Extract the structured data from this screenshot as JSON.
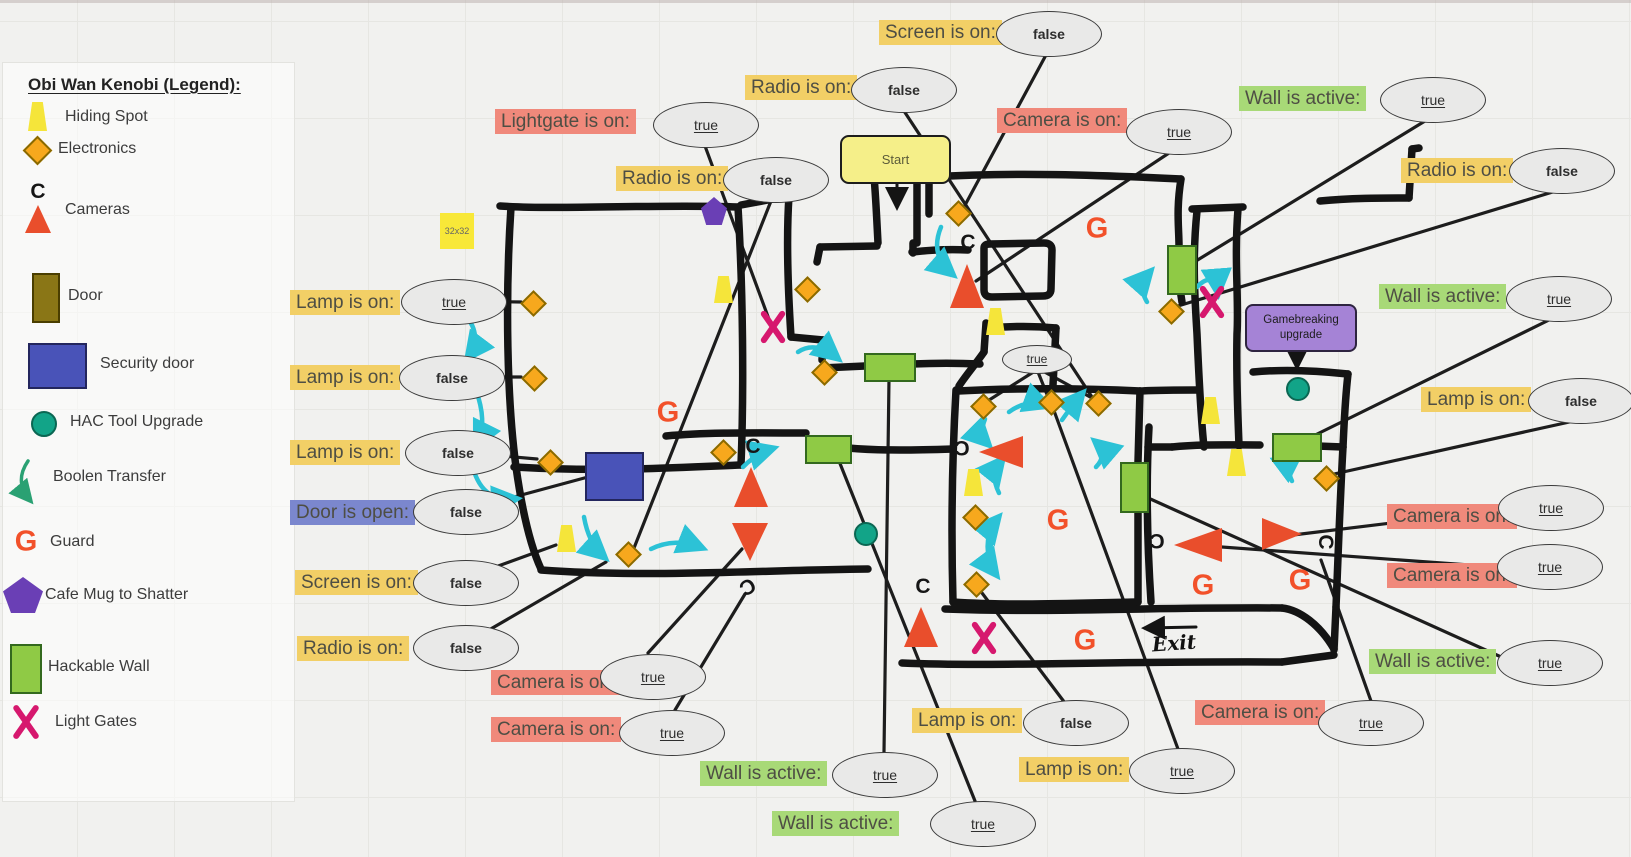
{
  "legend": {
    "title": "Obi Wan Kenobi (Legend):",
    "items": [
      {
        "icon": "hiding-spot",
        "label": "Hiding Spot",
        "y": 117,
        "icon_x": 38,
        "label_x": 65
      },
      {
        "icon": "electronics",
        "label": "Electronics",
        "y": 149,
        "icon_x": 36,
        "label_x": 58
      },
      {
        "icon": "camera",
        "label": "Cameras",
        "y": 210,
        "icon_x": 38,
        "label_x": 65
      },
      {
        "icon": "door",
        "label": "Door",
        "y": 296,
        "icon_x": 44,
        "label_x": 68
      },
      {
        "icon": "security-door",
        "label": "Security door",
        "y": 364,
        "icon_x": 55,
        "label_x": 100
      },
      {
        "icon": "hac-tool",
        "label": "HAC Tool Upgrade",
        "y": 422,
        "icon_x": 42,
        "label_x": 70
      },
      {
        "icon": "boolean-transfer",
        "label": "Boolen Transfer",
        "y": 477,
        "icon_x": 26,
        "label_x": 53
      },
      {
        "icon": "guard",
        "label": "Guard",
        "y": 542,
        "icon_x": 26,
        "label_x": 50
      },
      {
        "icon": "cafe-mug",
        "label": "Cafe Mug to Shatter",
        "y": 595,
        "icon_x": 23,
        "label_x": 45
      },
      {
        "icon": "hackable-wall",
        "label": "Hackable Wall",
        "y": 667,
        "icon_x": 24,
        "label_x": 48
      },
      {
        "icon": "light-gate",
        "label": "Light Gates",
        "y": 722,
        "icon_x": 26,
        "label_x": 55
      }
    ]
  },
  "notes": {
    "start": "Start",
    "exit": "Exit",
    "size_note": "32x32",
    "upgrade_line1": "Gamebreaking",
    "upgrade_line2": "upgrade"
  },
  "marks": {
    "guard_letter": "G",
    "camera_letter": "C"
  },
  "annotations": [
    {
      "id": "screen-top",
      "label": "Screen is on:",
      "bg": "yellow",
      "lx": 879,
      "ly": 20,
      "ex": 1048,
      "ey": 33,
      "value": "false"
    },
    {
      "id": "radio-top",
      "label": "Radio is on:",
      "bg": "yellow",
      "lx": 745,
      "ly": 75,
      "ex": 903,
      "ey": 89,
      "value": "false"
    },
    {
      "id": "lightgate-top",
      "label": "Lightgate is on:",
      "bg": "salmon",
      "lx": 495,
      "ly": 109,
      "ex": 705,
      "ey": 124,
      "value": "true"
    },
    {
      "id": "radio-mid",
      "label": "Radio is on:",
      "bg": "yellow",
      "lx": 616,
      "ly": 166,
      "ex": 775,
      "ey": 179,
      "value": "false"
    },
    {
      "id": "camera-top",
      "label": "Camera is on:",
      "bg": "salmon",
      "lx": 997,
      "ly": 108,
      "ex": 1178,
      "ey": 131,
      "value": "true"
    },
    {
      "id": "wall-top",
      "label": "Wall is active:",
      "bg": "green",
      "lx": 1239,
      "ly": 86,
      "ex": 1432,
      "ey": 99,
      "value": "true"
    },
    {
      "id": "radio-right",
      "label": "Radio is on:",
      "bg": "yellow",
      "lx": 1401,
      "ly": 158,
      "ex": 1561,
      "ey": 170,
      "value": "false"
    },
    {
      "id": "wall-right",
      "label": "Wall is active:",
      "bg": "green",
      "lx": 1379,
      "ly": 284,
      "ex": 1558,
      "ey": 298,
      "value": "true"
    },
    {
      "id": "lamp-right",
      "label": "Lamp is on:",
      "bg": "yellow",
      "lx": 1421,
      "ly": 387,
      "ex": 1580,
      "ey": 400,
      "value": "false"
    },
    {
      "id": "lamp-1",
      "label": "Lamp is on:",
      "bg": "yellow",
      "lx": 290,
      "ly": 290,
      "ex": 453,
      "ey": 301,
      "value": "true"
    },
    {
      "id": "lamp-2",
      "label": "Lamp is on:",
      "bg": "yellow",
      "lx": 290,
      "ly": 365,
      "ex": 451,
      "ey": 377,
      "value": "false"
    },
    {
      "id": "lamp-3",
      "label": "Lamp is on:",
      "bg": "yellow",
      "lx": 290,
      "ly": 440,
      "ex": 457,
      "ey": 452,
      "value": "false"
    },
    {
      "id": "door-open",
      "label": "Door is open:",
      "bg": "blue",
      "lx": 290,
      "ly": 500,
      "ex": 465,
      "ey": 511,
      "value": "false"
    },
    {
      "id": "screen-left",
      "label": "Screen is on:",
      "bg": "yellow",
      "lx": 295,
      "ly": 570,
      "ex": 465,
      "ey": 582,
      "value": "false"
    },
    {
      "id": "radio-left",
      "label": "Radio is on:",
      "bg": "yellow",
      "lx": 297,
      "ly": 636,
      "ex": 465,
      "ey": 647,
      "value": "false"
    },
    {
      "id": "camera-bl1",
      "label": "Camera is on:",
      "bg": "salmon",
      "lx": 491,
      "ly": 670,
      "ex": 652,
      "ey": 676,
      "value": "true"
    },
    {
      "id": "camera-bl2",
      "label": "Camera is on:",
      "bg": "salmon",
      "lx": 491,
      "ly": 717,
      "ex": 671,
      "ey": 732,
      "value": "true"
    },
    {
      "id": "wall-bc1",
      "label": "Wall is active:",
      "bg": "green",
      "lx": 700,
      "ly": 761,
      "ex": 884,
      "ey": 774,
      "value": "true"
    },
    {
      "id": "wall-bc2",
      "label": "Wall is active:",
      "bg": "green",
      "lx": 772,
      "ly": 811,
      "ex": 982,
      "ey": 823,
      "value": "true"
    },
    {
      "id": "lamp-bc1",
      "label": "Lamp is on:",
      "bg": "yellow",
      "lx": 912,
      "ly": 708,
      "ex": 1075,
      "ey": 722,
      "value": "false"
    },
    {
      "id": "lamp-bc2",
      "label": "Lamp is on:",
      "bg": "yellow",
      "lx": 1019,
      "ly": 757,
      "ex": 1181,
      "ey": 770,
      "value": "true"
    },
    {
      "id": "camera-bc",
      "label": "Camera is on:",
      "bg": "salmon",
      "lx": 1195,
      "ly": 700,
      "ex": 1370,
      "ey": 722,
      "value": "true"
    },
    {
      "id": "camera-r1",
      "label": "Camera is on:",
      "bg": "salmon",
      "lx": 1387,
      "ly": 504,
      "ex": 1550,
      "ey": 507,
      "value": "true"
    },
    {
      "id": "camera-r2",
      "label": "Camera is on:",
      "bg": "salmon",
      "lx": 1387,
      "ly": 563,
      "ex": 1549,
      "ey": 566,
      "value": "true"
    },
    {
      "id": "wall-r",
      "label": "Wall is active:",
      "bg": "green",
      "lx": 1369,
      "ly": 649,
      "ex": 1549,
      "ey": 662,
      "value": "true"
    },
    {
      "id": "inner-gate",
      "label": null,
      "bg": null,
      "ex": 1036,
      "ey": 358,
      "value": "true",
      "small": true
    }
  ],
  "map": {
    "diamonds": [
      [
        532,
        302
      ],
      [
        533,
        377
      ],
      [
        549,
        461
      ],
      [
        627,
        553
      ],
      [
        722,
        451
      ],
      [
        806,
        288
      ],
      [
        823,
        371
      ],
      [
        957,
        212
      ],
      [
        982,
        405
      ],
      [
        1050,
        401
      ],
      [
        1097,
        402
      ],
      [
        974,
        516
      ],
      [
        975,
        583
      ],
      [
        1170,
        310
      ],
      [
        1325,
        477
      ]
    ],
    "trapezoids": [
      [
        724,
        289
      ],
      [
        567,
        538
      ],
      [
        996,
        321
      ],
      [
        974,
        482
      ],
      [
        1211,
        410
      ],
      [
        1237,
        462
      ]
    ],
    "triangles": [
      {
        "x": 967,
        "y": 286,
        "w": 34,
        "h": 44,
        "dir": "up"
      },
      {
        "x": 751,
        "y": 487,
        "w": 34,
        "h": 40,
        "dir": "up"
      },
      {
        "x": 750,
        "y": 542,
        "w": 36,
        "h": 38,
        "dir": "down"
      },
      {
        "x": 1001,
        "y": 452,
        "w": 44,
        "h": 32,
        "dir": "left"
      },
      {
        "x": 921,
        "y": 627,
        "w": 34,
        "h": 40,
        "dir": "up"
      },
      {
        "x": 1198,
        "y": 545,
        "w": 48,
        "h": 34,
        "dir": "left"
      },
      {
        "x": 1282,
        "y": 534,
        "w": 40,
        "h": 32,
        "dir": "right"
      }
    ],
    "guards": [
      [
        668,
        413
      ],
      [
        1097,
        229
      ],
      [
        1058,
        521
      ],
      [
        1203,
        586
      ],
      [
        1300,
        581
      ],
      [
        1085,
        641
      ]
    ],
    "cameras_c": [
      {
        "x": 753,
        "y": 447,
        "r": 0
      },
      {
        "x": 968,
        "y": 243,
        "r": 0
      },
      {
        "x": 923,
        "y": 587,
        "r": 0
      },
      {
        "x": 962,
        "y": 447,
        "r": 180
      },
      {
        "x": 747,
        "y": 586,
        "r": 150
      },
      {
        "x": 1157,
        "y": 540,
        "r": 180
      },
      {
        "x": 1325,
        "y": 542,
        "r": 90
      }
    ],
    "hac_upgrades": [
      [
        864,
        532
      ],
      [
        1296,
        387
      ]
    ],
    "pentagons": [
      [
        714,
        211
      ]
    ],
    "light_gates": [
      [
        773,
        327
      ],
      [
        1212,
        302
      ],
      [
        984,
        638
      ]
    ],
    "hackable_walls": [
      {
        "x": 805,
        "y": 435,
        "w": 43,
        "h": 25
      },
      {
        "x": 864,
        "y": 353,
        "w": 48,
        "h": 25
      },
      {
        "x": 1167,
        "y": 245,
        "w": 26,
        "h": 46
      },
      {
        "x": 1120,
        "y": 462,
        "w": 25,
        "h": 47
      },
      {
        "x": 1272,
        "y": 433,
        "w": 46,
        "h": 25
      }
    ],
    "security_doors": [
      {
        "x": 585,
        "y": 452,
        "w": 55,
        "h": 45
      }
    ]
  },
  "colors": {
    "background": "#F1F1EF",
    "wall": "#141414",
    "label_yellow": "#F2CF66",
    "label_salmon": "#F0897B",
    "label_green": "#A8D977",
    "label_blue": "#7B87CE",
    "boolean_arrow": "#2CC2D6",
    "guard": "#F2512A",
    "light_gate": "#D6186E",
    "electronics": "#F7A81D",
    "hiding_spot": "#F5E53A",
    "hackable_wall": "#8FCA45",
    "security_door": "#4953B8",
    "hac_tool": "#12A488",
    "cafe_mug": "#6A3FB5",
    "door": "#8A7616",
    "start_fill": "#F5EF89",
    "upgrade_fill": "#A583D6",
    "ellipse_fill": "#E9E9E8"
  }
}
